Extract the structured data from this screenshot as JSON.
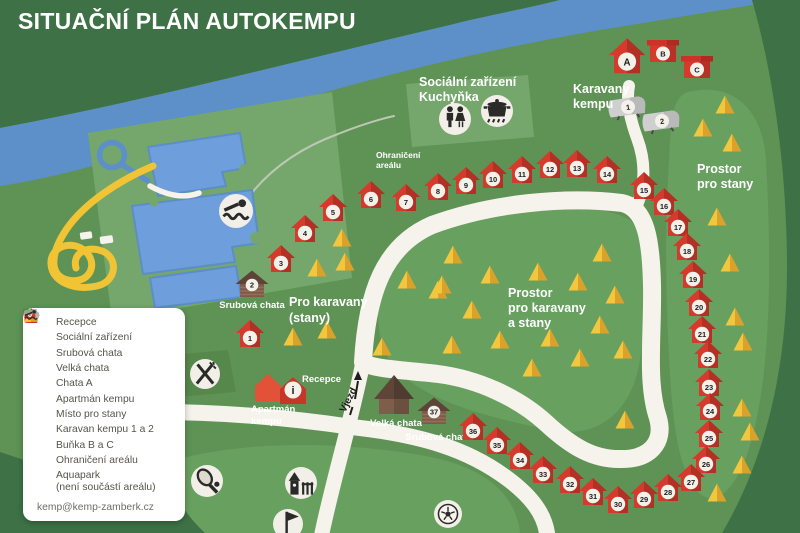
{
  "title": "SITUAČNÍ PLÁN AUTOKEMPU",
  "map_labels": {
    "social": {
      "line1": "Sociální zařízení",
      "line2": "Kuchyňka"
    },
    "karavany": {
      "line1": "Karavany",
      "line2": "kempu"
    },
    "prostor_stany": {
      "line1": "Prostor",
      "line2": "pro stany"
    },
    "ohraniceni": {
      "line1": "Ohraničení",
      "line2": "areálu"
    },
    "pro_karavany": {
      "line1": "Pro karavany",
      "line2": "(stany)"
    },
    "prostor_karavany": {
      "line1": "Prostor",
      "line2": "pro karavany",
      "line3": "a stany"
    },
    "recepce": "Recepce",
    "apartman": {
      "line1": "Apartmán",
      "line2": "kempu"
    },
    "vjezd": "Vjezd"
  },
  "map": {
    "huts": [
      [
        1,
        250,
        336
      ],
      [
        3,
        281,
        261
      ],
      [
        4,
        305,
        231
      ],
      [
        5,
        333,
        210
      ],
      [
        6,
        371,
        197
      ],
      [
        7,
        406,
        200
      ],
      [
        8,
        438,
        189
      ],
      [
        9,
        466,
        183
      ],
      [
        10,
        493,
        177
      ],
      [
        11,
        522,
        172
      ],
      [
        12,
        550,
        167
      ],
      [
        13,
        577,
        166
      ],
      [
        14,
        607,
        172
      ],
      [
        15,
        644,
        188
      ],
      [
        16,
        664,
        204
      ],
      [
        17,
        678,
        225
      ],
      [
        18,
        687,
        249
      ],
      [
        19,
        693,
        277
      ],
      [
        20,
        699,
        305
      ],
      [
        21,
        702,
        332
      ],
      [
        22,
        708,
        357
      ],
      [
        23,
        709,
        385
      ],
      [
        24,
        710,
        409
      ],
      [
        25,
        709,
        436
      ],
      [
        26,
        706,
        462
      ],
      [
        27,
        691,
        480
      ],
      [
        28,
        668,
        490
      ],
      [
        29,
        644,
        497
      ],
      [
        30,
        618,
        502
      ],
      [
        31,
        593,
        494
      ],
      [
        32,
        570,
        482
      ],
      [
        33,
        543,
        472
      ],
      [
        34,
        520,
        458
      ],
      [
        35,
        497,
        443
      ],
      [
        36,
        473,
        429
      ]
    ],
    "letter_huts": [
      {
        "label": "A",
        "x": 627,
        "y": 59
      }
    ],
    "boxes": [
      {
        "label": "B",
        "x": 663,
        "y": 52
      },
      {
        "label": "C",
        "x": 697,
        "y": 68
      }
    ],
    "caravans": [
      {
        "n": "1",
        "x": 628,
        "y": 107
      },
      {
        "n": "2",
        "x": 662,
        "y": 121
      }
    ],
    "cabins": [
      {
        "n": "2",
        "x": 252,
        "y": 286,
        "label": "Srubová chata",
        "lx": 252,
        "ly": 308
      },
      {
        "n": "37",
        "x": 434,
        "y": 413,
        "label": "Srubová chata",
        "lx": 438,
        "ly": 440
      }
    ],
    "big_house": {
      "x": 394,
      "y": 396,
      "label": "Velká chata",
      "lx": 396,
      "ly": 426
    },
    "apartman_houses": [
      [
        268,
        388
      ],
      [
        293,
        391
      ]
    ],
    "info_letter": "i",
    "tents": [
      [
        342,
        238
      ],
      [
        317,
        268
      ],
      [
        345,
        262
      ],
      [
        293,
        337
      ],
      [
        327,
        330
      ],
      [
        382,
        347
      ],
      [
        407,
        280
      ],
      [
        438,
        290
      ],
      [
        453,
        255
      ],
      [
        442,
        285
      ],
      [
        490,
        275
      ],
      [
        472,
        310
      ],
      [
        538,
        272
      ],
      [
        578,
        282
      ],
      [
        602,
        253
      ],
      [
        615,
        295
      ],
      [
        600,
        325
      ],
      [
        500,
        340
      ],
      [
        452,
        345
      ],
      [
        550,
        338
      ],
      [
        580,
        358
      ],
      [
        623,
        350
      ],
      [
        532,
        368
      ],
      [
        625,
        420
      ],
      [
        717,
        493
      ],
      [
        742,
        465
      ],
      [
        703,
        128
      ],
      [
        725,
        105
      ],
      [
        732,
        143
      ],
      [
        717,
        217
      ],
      [
        730,
        263
      ],
      [
        735,
        317
      ],
      [
        743,
        342
      ],
      [
        742,
        408
      ],
      [
        750,
        432
      ]
    ],
    "amenities": [
      {
        "icon": "swimmer",
        "x": 236,
        "y": 211,
        "r": 17
      },
      {
        "icon": "bed",
        "x": 168,
        "y": 372,
        "r": 15
      },
      {
        "icon": "utensils",
        "x": 205,
        "y": 374,
        "r": 15
      },
      {
        "icon": "wc",
        "x": 455,
        "y": 119,
        "r": 16
      },
      {
        "icon": "pot",
        "x": 497,
        "y": 111,
        "r": 16
      },
      {
        "icon": "tennis",
        "x": 207,
        "y": 481,
        "r": 16
      },
      {
        "icon": "playground",
        "x": 301,
        "y": 483,
        "r": 16
      },
      {
        "icon": "flag",
        "x": 288,
        "y": 524,
        "r": 15
      },
      {
        "icon": "soccer",
        "x": 448,
        "y": 514,
        "r": 14
      }
    ]
  },
  "legend": {
    "items": [
      {
        "icon": "hut-red",
        "label": "Recepce"
      },
      {
        "icon": "people",
        "label": "Sociální zařízení"
      },
      {
        "icon": "cabin",
        "label": "Srubová chata"
      },
      {
        "icon": "house-brown",
        "label": "Velká chata"
      },
      {
        "icon": "hut-a",
        "label": "Chata A"
      },
      {
        "icon": "house-red",
        "label": "Apartmán kempu"
      },
      {
        "icon": "tent",
        "label": "Místo pro stany"
      },
      {
        "icon": "caravan",
        "label": "Karavan kempu 1 a 2"
      },
      {
        "icon": "box-red",
        "label": "Buňka B a C"
      },
      {
        "icon": "boundary",
        "label": "Ohraničení areálu"
      },
      {
        "icon": "swimmer",
        "label": "Aquapark",
        "label2": "(není součástí areálu)"
      }
    ],
    "email": "kemp@kemp-zamberk.cz"
  },
  "colors": {
    "outer_green": "#3e7246",
    "camp_green": "#5e9355",
    "light_green": "#68a060",
    "panel_green": "#75a76d",
    "river_blue": "#5d90c8",
    "pool_blue": "#6f9edc",
    "road": "#f6f3ec",
    "hut_red": "#d63a2c",
    "tent_yellow": "#f2c73e",
    "cabin_brown": "#7d5b48",
    "slide_yellow": "#f0c435"
  }
}
